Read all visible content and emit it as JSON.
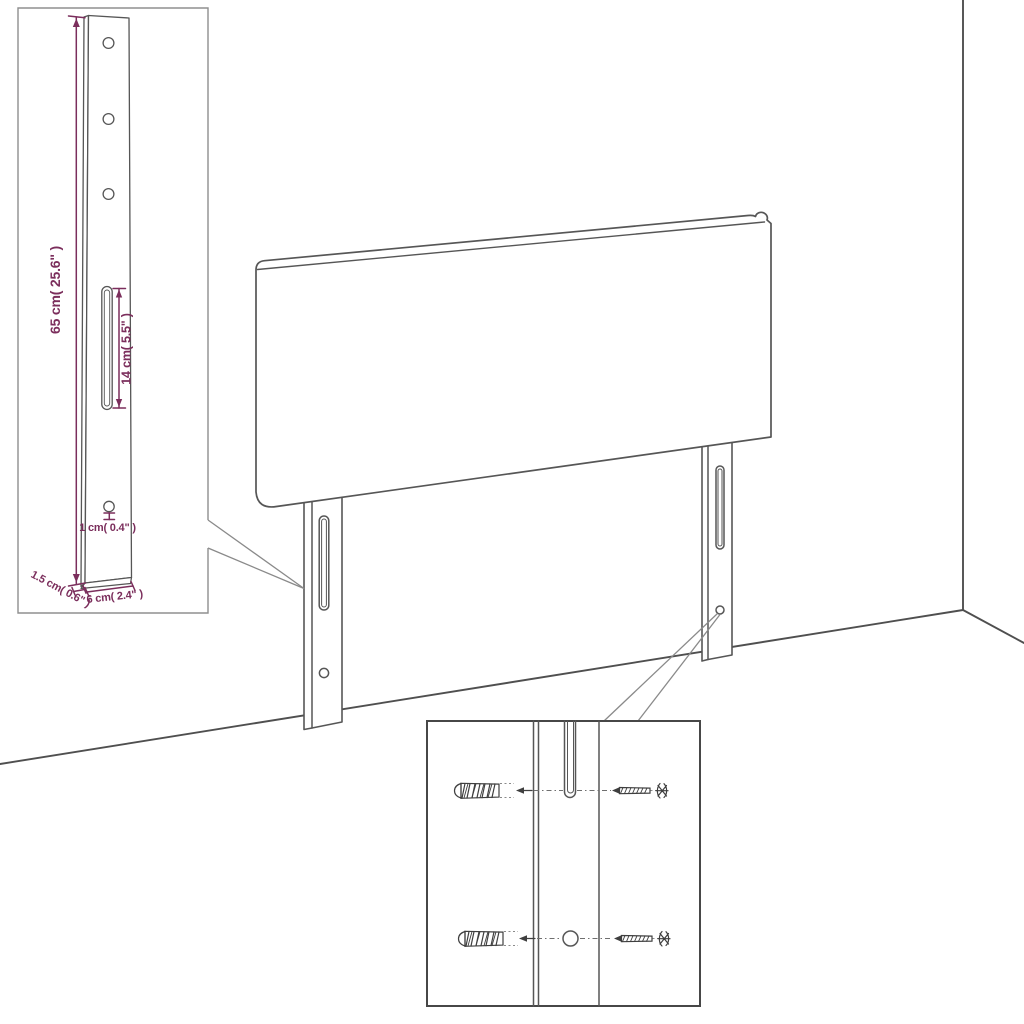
{
  "page": {
    "background": "#ffffff",
    "figure_type": "headboard-assembly-dimension-diagram"
  },
  "colors": {
    "outline_gray": "#565656",
    "dimension_magenta": "#7b2e5c",
    "detail_inset_border": "#8f8f8f",
    "hardware_inset_border": "#474747"
  },
  "leg_detail_inset": {
    "labels": {
      "height": "65 cm( 25.6\" )",
      "slot": "14 cm( 5.5\" )",
      "hole": "1 cm( 0.4\" )",
      "thickness": "1.5 cm( 0.6\" )",
      "width": "6 cm( 2.4\" )"
    },
    "hole_count_top": 3,
    "slot_count": 1,
    "hole_count_bottom": 1
  },
  "hardware_inset": {
    "wall_plug_count": 2,
    "screw_count": 2,
    "rows": 2,
    "icons": [
      "wall-plug-icon",
      "screw-icon",
      "hole-icon",
      "slot-icon"
    ]
  },
  "main_view": {
    "icons": [
      "headboard-outline",
      "left-leg",
      "right-leg",
      "room-corner"
    ]
  }
}
